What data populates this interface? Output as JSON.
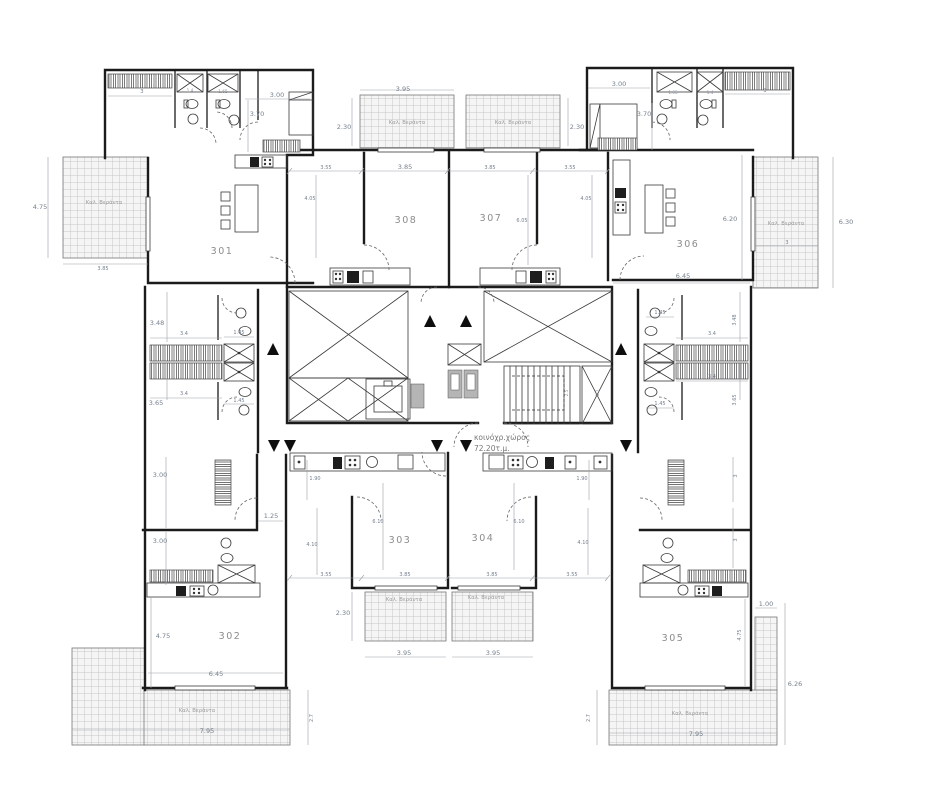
{
  "labels": {
    "balcony": "Καλ. Βεράντα",
    "common_line1": "κοινόχρ.χώρος",
    "common_line2": "72.20τ.μ."
  },
  "rooms": {
    "r301": "301",
    "r302": "302",
    "r303": "303",
    "r304": "304",
    "r305": "305",
    "r306": "306",
    "r307": "307",
    "r308": "308"
  },
  "dims": {
    "tl_wr": "3",
    "tl_sh1": "1.4",
    "tl_sh2": "1.65",
    "tl_bw": "3.00",
    "tl_bh": "3.70",
    "tcb_w": "3.95",
    "tcb_dl": "2.30",
    "tcb_dr": "2.30",
    "tr_bw": "3.00",
    "tr_bh": "3.70",
    "tr_sh1": "1.65",
    "tr_sh2": "1.4",
    "tr_wr": "3",
    "trow1": "3.55",
    "trow2": "3.85",
    "trow3": "3.85",
    "trow4": "3.55",
    "tvl": "4.05",
    "tvm": "6.05",
    "tvr": "4.05",
    "tlb_h": "4.75",
    "tlb_w": "3.85",
    "tr_rh": "6.20",
    "trb_h": "6.30",
    "trb_w": "3",
    "tr_rw": "6.45",
    "ml1": "3.48",
    "ml2": "3.4",
    "ml3": "1.45",
    "ml4": "3.4",
    "ml5": "1.45",
    "ml6": "3.65",
    "mr1": "3.48",
    "mr2": "3.4",
    "mr3": "1.45",
    "mr4": "3.4",
    "mr5": "1.45",
    "mr6": "3.65",
    "st1": "2.5",
    "st2": "1.2",
    "bl1": "3.00",
    "bl2": "3.00",
    "bl3": "1.25",
    "bl4": "1.90",
    "br4": "1.90",
    "bvl": "6.10",
    "bvr": "6.10",
    "bvl2": "4.10",
    "bvr2": "4.10",
    "brow1": "3.55",
    "brow2": "3.85",
    "brow3": "3.85",
    "brow4": "3.55",
    "bcb_d": "2.30",
    "bcb_wl": "3.95",
    "bcb_wr": "3.95",
    "blb_h": "4.75",
    "bl_rw": "6.45",
    "blb_w": "7.95",
    "blb_d": "2.7",
    "br_gap": "1.00",
    "br_rh": "4.75",
    "brs1": "3",
    "brs2": "3",
    "brb_h": "6.26",
    "brb_w": "7.95",
    "brb_d": "2.7"
  }
}
